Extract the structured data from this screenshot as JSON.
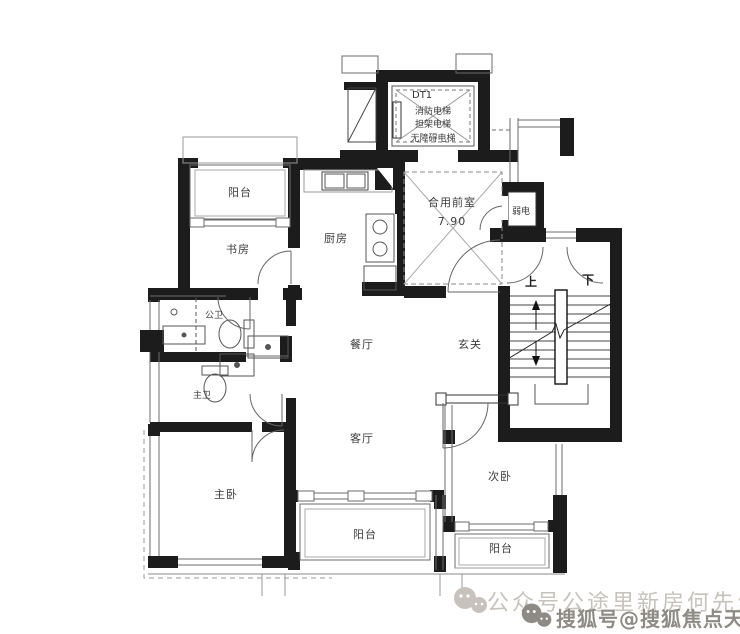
{
  "plan": {
    "elevator": {
      "id": "DT1",
      "line1": "消防电梯",
      "line2": "担架电梯",
      "line3": "无障碍电梯"
    },
    "lobby": {
      "name": "合用前室",
      "area": "7.90"
    },
    "utility": {
      "weak_current": "弱电"
    },
    "stairs": {
      "up": "上",
      "down": "下"
    },
    "rooms": {
      "balcony_top": "阳台",
      "study": "书房",
      "kitchen": "厨房",
      "dining": "餐厅",
      "foyer": "玄关",
      "guest_bath": "公卫",
      "master_bath": "主卫",
      "living": "客厅",
      "master_bed": "主卧",
      "second_bed": "次卧",
      "balcony_bottom": "阳台",
      "balcony_right": "阳台"
    }
  },
  "watermark": {
    "line1": "公众号公途里新房何先生",
    "line2": "搜狐号@搜狐焦点天门站"
  },
  "colors": {
    "wall": "#1c1c1c",
    "line": "#6b6b6b",
    "light": "#a9a9a9",
    "label": "#3c3c3c",
    "wm1": "#c7c3bc",
    "wm2": "#8e8a84"
  }
}
